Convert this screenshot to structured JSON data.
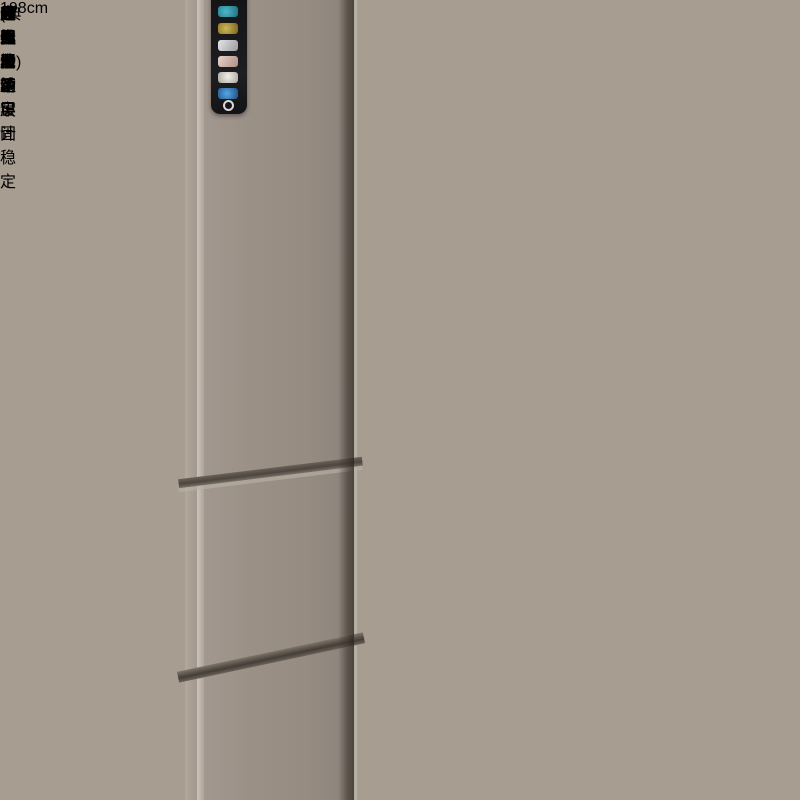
{
  "header": {
    "variant_title": "(典雅白)"
  },
  "feature_badges": [
    {
      "label": "夹缝收纳"
    },
    {
      "label": "自由移动"
    },
    {
      "label": "分类分区"
    }
  ],
  "height_label": "198cm",
  "inset_cards": [
    {
      "caption": "底部滑轮设计"
    },
    {
      "caption": "无惧承重 牢固稳定",
      "seal_small_text": "最大承重",
      "seal_main_text": "超强承重"
    },
    {
      "emboss_top": "高温烤漆层",
      "emboss_bottom": "哑光层"
    }
  ],
  "colors": {
    "sidebar_gold_top": "#a18b66",
    "sidebar_gold_bottom": "#cfc2a6",
    "rail_white": "#f0ede5",
    "fridge_taupe": "#9a9086",
    "seal_gold": "#d4ab5e",
    "seal_text_red": "#993d22",
    "height_text": "#3c3b39"
  }
}
